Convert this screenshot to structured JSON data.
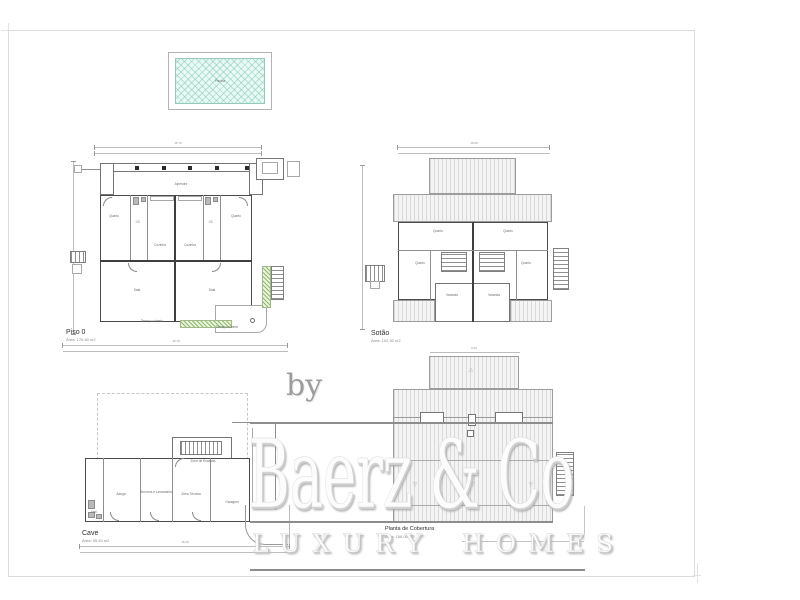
{
  "sheet": {
    "border_color": "#dcdcdc",
    "background": "#ffffff"
  },
  "colors": {
    "pool_water": "#e9faf4",
    "planter_green": "#8fbc6a",
    "roof_hatch": "#d9d9d9",
    "watermark_gray": "#9c9c9c"
  },
  "pool": {
    "label": "Piscina"
  },
  "plans": {
    "piso0": {
      "title": "Piso 0",
      "area_note": "Área: 176.60 m2",
      "dim_top_total": "15.70",
      "dim_bottom_total": "15.70",
      "rooms": [
        "Alpendre",
        "Quarto",
        "I.S.",
        "Cozinha",
        "Cozinha",
        "I.S.",
        "Quarto",
        "Sala",
        "Sala",
        "Terraço coberto",
        "Terraço coberto"
      ]
    },
    "sotao": {
      "title": "Sotão",
      "area_note": "Área: 102.30 m2",
      "dim_top_total": "10.95",
      "rooms": [
        "Quarto",
        "Quarto",
        "Quarto",
        "Quarto",
        "Varanda",
        "Varanda"
      ]
    },
    "cave": {
      "title": "Cave",
      "area_note": "Área: 95.40 m2",
      "dim_bottom_total": "15.40",
      "rooms": [
        "Zona de Escadas",
        "Adega",
        "Arrumos e Lavandaria",
        "Zona Técnica",
        "Garagem",
        "Hall"
      ]
    },
    "cobertura": {
      "title": "Planta de Cobertura",
      "area_note": "Área: 168.00 m2",
      "dim_top_total": "9.40",
      "marks": [
        "△",
        "▽",
        "▽",
        "▽"
      ]
    }
  },
  "watermark": {
    "by_label": "by",
    "brand": "Baerz & Co",
    "tagline": "LUXURY HOMES"
  }
}
